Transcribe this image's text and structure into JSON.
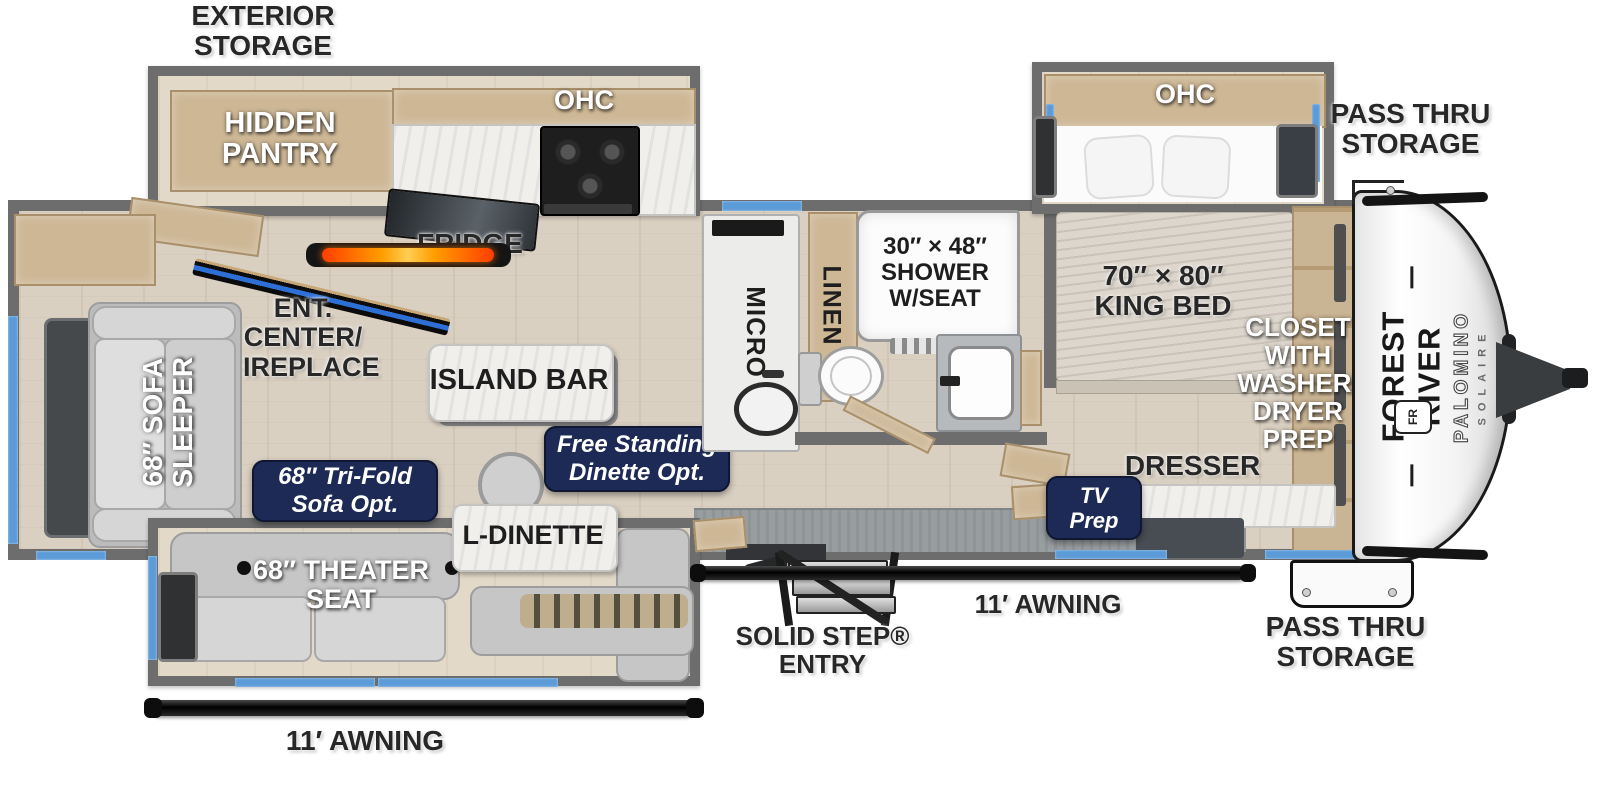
{
  "colors": {
    "wall_gray": "#6d6d6d",
    "floor_wood": "#dad0c2",
    "cabinet_tan": "#cdb795",
    "window_blue": "#5b9bd8",
    "badge_navy": "#1d2a55",
    "fire_orange": "#ff8a00",
    "label_dark": "#272727"
  },
  "exterior": {
    "exterior_storage": "EXTERIOR\nSTORAGE",
    "pass_thru_top": "PASS THRU\nSTORAGE",
    "pass_thru_bottom": "PASS THRU\nSTORAGE",
    "awning_rear": "11′ AWNING",
    "awning_front": "11′ AWNING",
    "solid_step": "SOLID STEP®\nENTRY"
  },
  "kitchen": {
    "hidden_pantry": "HIDDEN\nPANTRY",
    "ohc": "OHC",
    "fridge": "FRIDGE",
    "micro": "MICRO",
    "island_bar": "ISLAND BAR",
    "ent_center": "ENT.\nCENTER/\nFIREPLACE"
  },
  "living": {
    "sofa_sleeper": "68″ SOFA\nSLEEPER",
    "tri_fold_option": "68″ Tri-Fold\nSofa Opt.",
    "dinette_option": "Free Standing\nDinette Opt.",
    "theater_seat": "68″ THEATER\nSEAT",
    "l_dinette": "L-DINETTE"
  },
  "bathroom": {
    "linen": "LINEN",
    "shower": "30″ × 48″\nSHOWER\nW/SEAT"
  },
  "bedroom": {
    "ohc": "OHC",
    "king_bed": "70″ × 80″\nKING BED",
    "closet": "CLOSET\nWITH\nWASHER/\nDRYER\nPREP",
    "dresser": "DRESSER",
    "tv_prep": "TV\nPrep"
  },
  "brand": {
    "maker": "FOREST RIVER",
    "line": "PALOMINO",
    "model": "SOLAIRE",
    "logo": "FR"
  }
}
